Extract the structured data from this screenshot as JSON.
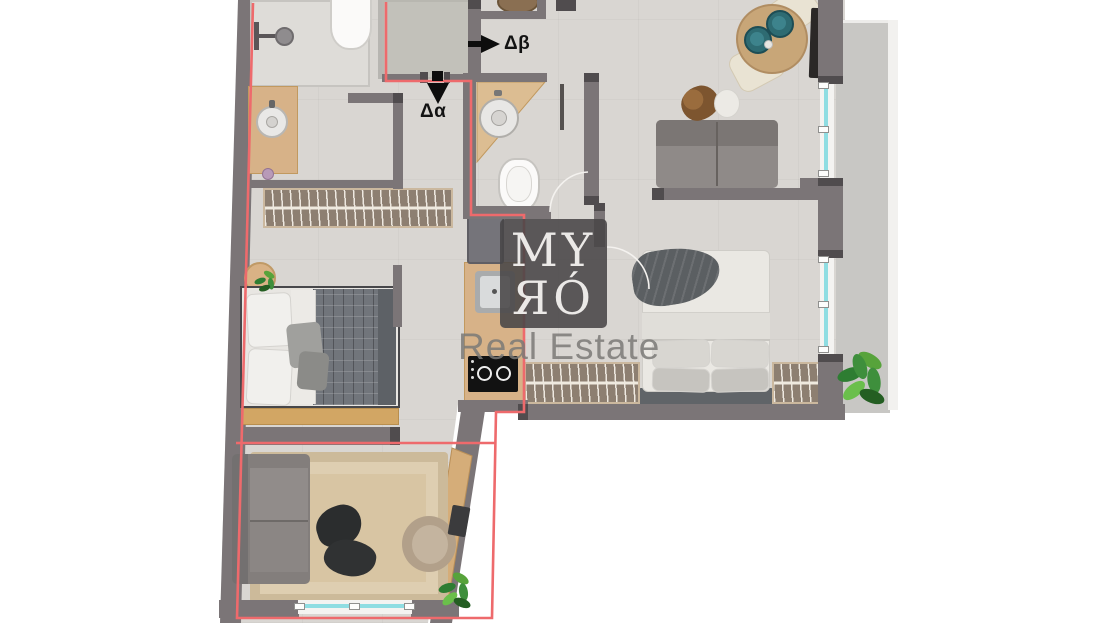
{
  "plan": {
    "watermark": {
      "brand_line1": "MY",
      "brand_line2": "ЯÓ",
      "subtitle": "Real Estate"
    },
    "entrance_labels": {
      "alpha": "Δα",
      "beta": "Δβ"
    },
    "palette": {
      "background": "#ffffff",
      "wall": "#7b7577",
      "wall_dark": "#504c4e",
      "unit_boundary_red": "#ee6a6c",
      "floor": "#d9d6d2",
      "entry_landing": "#c2c1ba",
      "balcony_floor": "#c8c7c4",
      "window_glass": "#8fdde2",
      "wood": "#d7b288",
      "wardrobe_fill": "#8d7f71",
      "wardrobe_trim": "#cbb89e",
      "rug_jute": "#d8c5a3",
      "sofa_gray": "#8a8583",
      "bed_duvet": "#eae8e3",
      "plaid_duvet": "#70747a",
      "coffee_table_black": "#2b2d2e",
      "armchair_beige": "#b2a08a",
      "dining_table_wood": "#c8a678",
      "plate_teal": "#2e6b72",
      "plant_green": "#3e8f3c",
      "watermark_bg": "rgba(72,69,71,0.88)",
      "watermark_text": "#ebe9e7",
      "subtitle_gray": "#7a7977"
    },
    "elements": [
      "shower",
      "toilet",
      "bathroom-vanity-sink",
      "hall-wardrobe",
      "entry-landing",
      "corner-sink",
      "wc-toilet",
      "fridge",
      "kitchen-sink",
      "cooktop",
      "double-bed-with-pillows",
      "bedside-table-plant",
      "bed-bench",
      "sofa",
      "jute-rug",
      "black-coffee-table",
      "armchair",
      "desk",
      "desk-plant",
      "loveseat",
      "side-tables",
      "round-dining-table",
      "dining-chairs",
      "tv",
      "bedroom-wardrobes",
      "balcony",
      "balcony-plant",
      "windows",
      "doors"
    ]
  }
}
